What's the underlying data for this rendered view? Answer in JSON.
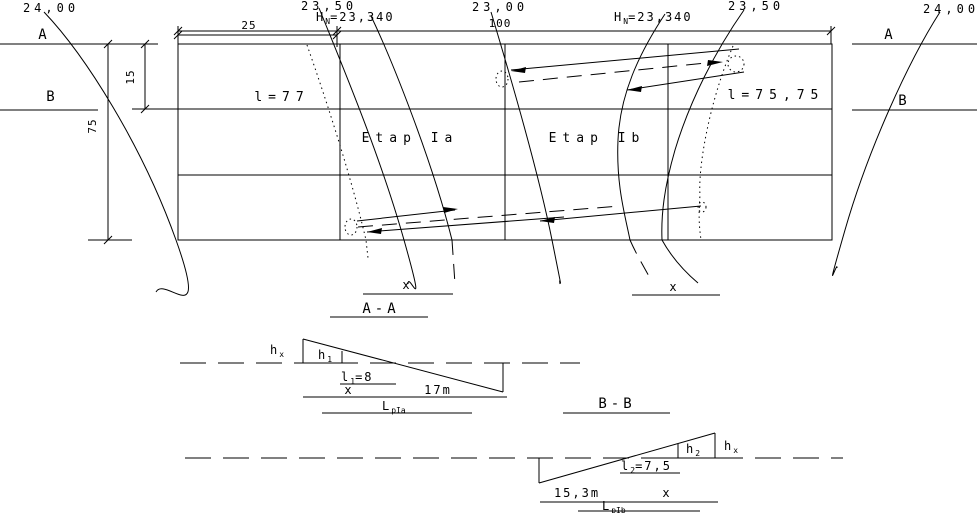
{
  "plan": {
    "contours": {
      "far_left": "24,00",
      "left": "23,50",
      "center": "23,00",
      "right": "23,50",
      "far_right": "24,00"
    },
    "levels": {
      "left": {
        "base": "H",
        "sub": "N",
        "rest": "=23,340"
      },
      "right": {
        "base": "H",
        "sub": "N",
        "rest": "=23,340"
      }
    },
    "markers": {
      "a_left": "A",
      "b_left": "B",
      "a_right": "A",
      "b_right": "B"
    },
    "dims": {
      "col": "25",
      "span": "100",
      "row": "15",
      "height": "75"
    },
    "cells": {
      "left_len": "l=77",
      "stage_a": "Etap Ia",
      "stage_b": "Etap Ib",
      "right_len": "l=75,75"
    },
    "x_left": "x",
    "x_right": "x"
  },
  "sections": {
    "aa": {
      "title": "A-A",
      "hx": {
        "base": "h",
        "sub": "x"
      },
      "h1": {
        "base": "h",
        "sub": "1"
      },
      "l1": {
        "base": "l",
        "sub": "1",
        "rest": "=8"
      },
      "x": "x",
      "length": "17m",
      "lp": {
        "base": "L",
        "sub": "pIa"
      }
    },
    "bb": {
      "title": "B-B",
      "h2": {
        "base": "h",
        "sub": "2"
      },
      "hx": {
        "base": "h",
        "sub": "x"
      },
      "l2": {
        "base": "l",
        "sub": "2",
        "rest": "=7,5"
      },
      "length": "15,3m",
      "x": "x",
      "lp": {
        "base": "L",
        "sub": "pIb"
      }
    }
  },
  "colors": {
    "ink": "#000000",
    "paper": "#ffffff"
  }
}
